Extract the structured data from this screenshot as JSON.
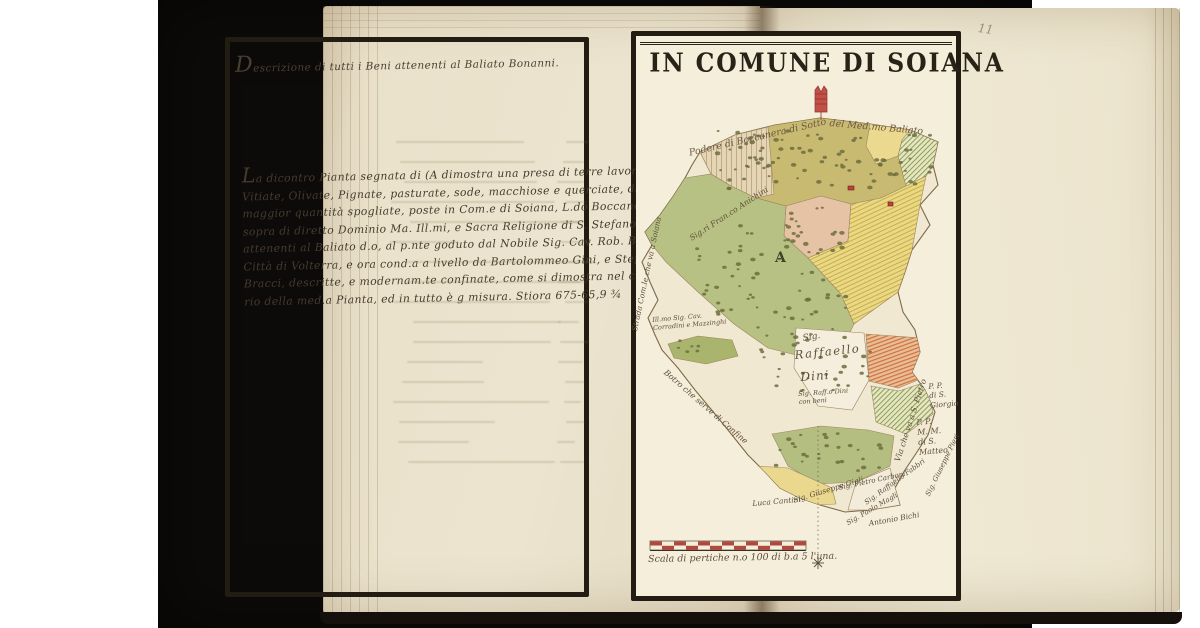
{
  "photo": {
    "page_number": "11"
  },
  "left_page": {
    "heading": "Descrizione di tutti i Beni attenenti al Baliato Bonanni.",
    "body_lines": [
      "La dicontro Pianta segnata di (A dimostra una presa di terre lavorative,",
      "Vitiate, Olivate, Pignate, pasturate, sode, macchiose e querciate, da cigli la",
      "maggior quantità spogliate, poste in Com.e di Soiana, L.do Boccanera di",
      "sopra di diretto Dominio Ma. Ill.mi, e Sacra Religione di S. Stefano P.o M.,",
      "attenenti al Baliato d.o, al p.nte goduto dal Nobile Sig. Cav. Rob. Bened.i",
      "Città di Volterra, e ora cond.a a livello da Bartolommeo Gini, e Stefano",
      "Bracci, descritte, e modernam.te confinate, come si dimostra nel circonda-",
      "rio della med.a Pianta, ed in tutto è g misura. Stiora 675-65,9 ¾"
    ]
  },
  "map": {
    "title": "IN COMUNE DI SOIANA",
    "parcel_letter": "A",
    "scale_caption": "Scala di pertiche n.o 100 di b.a 5 l'una.",
    "labels": {
      "top_boundary_1": "Podere di Boccanera di Sotto",
      "top_boundary_2": "del Med.mo Baliato",
      "left_owner": "Sig.ri Fran.co Anichini",
      "left_road": "Strada Com.le che va a Soiana",
      "left_owner2": "Ill.mo Sig. Cav.\nCorradini e Mazzinghi",
      "stream": "Botro che serve di Confine",
      "right_road": "Via che va a S. Pietro",
      "dini_line1": "Sig.",
      "dini_line2": "Raffaello",
      "dini_line3": "Dini",
      "dini_sub": "Sig. Raff.o Dini\ncon beni",
      "pp_giorgio": "P. P.\ndi S.\nGiorgio",
      "pp_matteo": "P. P.\nM. M.\ndi S.\nMatteo",
      "fabbri": "Sig. Raffaello Fabbri",
      "pieri": "Sig. Giuseppe Pieri",
      "bichi": "Antonio Bichi",
      "cantini": "Luca Cantini",
      "gigli": "Sig. Giuseppe Gigli",
      "carboni": "Sig. Pietro Carboni",
      "magli": "Sig. Paolo Magli"
    }
  }
}
